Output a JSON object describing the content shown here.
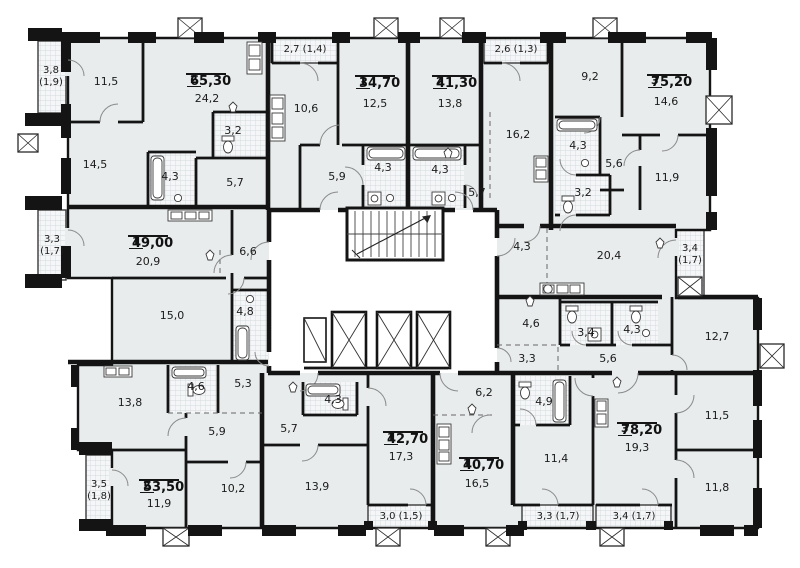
{
  "plan": {
    "colors": {
      "room_fill": "#e8eced",
      "corridor_fill": "#ffffff",
      "wall": "#141414",
      "tile_line": "#ccd3d7",
      "tile_bg": "#f4f6f7",
      "door_arc": "#8a8a8a"
    },
    "apartments": [
      {
        "rooms": "2",
        "area": "65,30",
        "x": 206,
        "y": 74
      },
      {
        "rooms": "1",
        "area": "34,70",
        "x": 375,
        "y": 76
      },
      {
        "rooms": "2",
        "area": "41,30",
        "x": 452,
        "y": 76
      },
      {
        "rooms": "3",
        "area": "75,20",
        "x": 667,
        "y": 75
      },
      {
        "rooms": "1",
        "area": "49,00",
        "x": 148,
        "y": 236
      },
      {
        "rooms": "2",
        "area": "53,50",
        "x": 159,
        "y": 480
      },
      {
        "rooms": "1",
        "area": "42,70",
        "x": 403,
        "y": 432
      },
      {
        "rooms": "1",
        "area": "40,70",
        "x": 479,
        "y": 458
      },
      {
        "rooms": "3",
        "area": "78,20",
        "x": 637,
        "y": 423
      }
    ],
    "room_labels": [
      {
        "text": "11,5",
        "x": 106,
        "y": 82
      },
      {
        "text": "24,2",
        "x": 207,
        "y": 99
      },
      {
        "text": "3,2",
        "x": 233,
        "y": 131
      },
      {
        "text": "14,5",
        "x": 95,
        "y": 165
      },
      {
        "text": "4,3",
        "x": 170,
        "y": 177
      },
      {
        "text": "5,7",
        "x": 235,
        "y": 183
      },
      {
        "text": "10,6",
        "x": 306,
        "y": 109
      },
      {
        "text": "12,5",
        "x": 375,
        "y": 104
      },
      {
        "text": "13,8",
        "x": 450,
        "y": 104
      },
      {
        "text": "16,2",
        "x": 518,
        "y": 135
      },
      {
        "text": "5,9",
        "x": 337,
        "y": 177
      },
      {
        "text": "4,3",
        "x": 383,
        "y": 168
      },
      {
        "text": "4,3",
        "x": 440,
        "y": 170
      },
      {
        "text": "5,7",
        "x": 477,
        "y": 193
      },
      {
        "text": "9,2",
        "x": 590,
        "y": 77
      },
      {
        "text": "14,6",
        "x": 666,
        "y": 102
      },
      {
        "text": "4,3",
        "x": 578,
        "y": 146
      },
      {
        "text": "5,6",
        "x": 614,
        "y": 164
      },
      {
        "text": "11,9",
        "x": 667,
        "y": 178
      },
      {
        "text": "3,2",
        "x": 583,
        "y": 193
      },
      {
        "text": "20,9",
        "x": 148,
        "y": 262
      },
      {
        "text": "6,6",
        "x": 248,
        "y": 252
      },
      {
        "text": "15,0",
        "x": 172,
        "y": 316
      },
      {
        "text": "4,8",
        "x": 245,
        "y": 312
      },
      {
        "text": "4,3",
        "x": 522,
        "y": 247
      },
      {
        "text": "20,4",
        "x": 609,
        "y": 256
      },
      {
        "text": "4,6",
        "x": 531,
        "y": 324
      },
      {
        "text": "3,4",
        "x": 586,
        "y": 333
      },
      {
        "text": "4,3",
        "x": 632,
        "y": 330
      },
      {
        "text": "12,7",
        "x": 717,
        "y": 337
      },
      {
        "text": "3,3",
        "x": 527,
        "y": 359
      },
      {
        "text": "5,6",
        "x": 608,
        "y": 359
      },
      {
        "text": "13,8",
        "x": 130,
        "y": 403
      },
      {
        "text": "4,6",
        "x": 196,
        "y": 387
      },
      {
        "text": "5,3",
        "x": 243,
        "y": 384
      },
      {
        "text": "5,9",
        "x": 217,
        "y": 432
      },
      {
        "text": "11,9",
        "x": 159,
        "y": 504
      },
      {
        "text": "10,2",
        "x": 233,
        "y": 489
      },
      {
        "text": "4,3",
        "x": 333,
        "y": 400
      },
      {
        "text": "5,7",
        "x": 289,
        "y": 429
      },
      {
        "text": "13,9",
        "x": 317,
        "y": 487
      },
      {
        "text": "17,3",
        "x": 401,
        "y": 457
      },
      {
        "text": "6,2",
        "x": 484,
        "y": 393
      },
      {
        "text": "16,5",
        "x": 477,
        "y": 484
      },
      {
        "text": "4,9",
        "x": 544,
        "y": 402
      },
      {
        "text": "11,4",
        "x": 556,
        "y": 459
      },
      {
        "text": "19,3",
        "x": 637,
        "y": 448
      },
      {
        "text": "11,5",
        "x": 717,
        "y": 416
      },
      {
        "text": "11,8",
        "x": 717,
        "y": 488
      }
    ],
    "balcony_labels": [
      {
        "text": "3,8\n(1,9)",
        "x": 51,
        "y": 77
      },
      {
        "text": "2,7 (1,4)",
        "x": 305,
        "y": 50
      },
      {
        "text": "2,6 (1,3)",
        "x": 516,
        "y": 50
      },
      {
        "text": "3,3\n(1,7)",
        "x": 52,
        "y": 246
      },
      {
        "text": "3,4\n(1,7)",
        "x": 690,
        "y": 255
      },
      {
        "text": "3,5\n(1,8)",
        "x": 99,
        "y": 491
      },
      {
        "text": "3,0 (1,5)",
        "x": 401,
        "y": 517
      },
      {
        "text": "3,3 (1,7)",
        "x": 558,
        "y": 517
      },
      {
        "text": "3,4 (1,7)",
        "x": 634,
        "y": 517
      }
    ]
  }
}
